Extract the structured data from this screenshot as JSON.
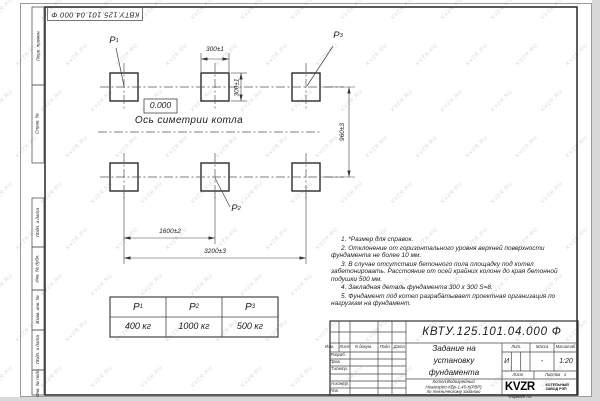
{
  "watermark": {
    "text": "KVZR.RU"
  },
  "frame": {
    "designation_rotated": "КВТУ.125.101.04.000 Ф",
    "format_label": "Формат А3",
    "margin_columns": [
      "Перв. примен.",
      "Справ. №",
      "Подп. и дата",
      "Инв. № дубл.",
      "Взам. инв. №",
      "Подп. и дата",
      "Инв. № подл."
    ]
  },
  "drawing": {
    "elevation_mark": "0.000",
    "axis_label": "Ось симетрии котла",
    "position_labels": [
      {
        "base": "P",
        "sub": "1"
      },
      {
        "base": "P",
        "sub": "2"
      },
      {
        "base": "P",
        "sub": "3"
      }
    ],
    "dimensions": {
      "pad_width": "300±1",
      "pad_height": "300±1",
      "row_spacing": "960±3",
      "column_spacing": "1600±2",
      "total_length": "3200±3"
    }
  },
  "load_table": {
    "headers": [
      {
        "base": "P",
        "sub": "1"
      },
      {
        "base": "P",
        "sub": "2"
      },
      {
        "base": "P",
        "sub": "3"
      }
    ],
    "values": [
      "400 кг",
      "1000 кг",
      "500 кг"
    ]
  },
  "notes": [
    "1. *Размер для справок.",
    "2. Отклонение от горизонтального уровня верхней поверхности фундамента не более 10 мм.",
    "3. В случае отсутствия бетонного пола площадку под котел забетонировать. Расстояние от осей крайних колонн до края бетонной подушки 500 мм.",
    "4. Закладная деталь фундамента 300 x 300 S=8.",
    "5. Фундамент под котел разрабатывает проектная организация по нагрузкам на фундамент."
  ],
  "title_block": {
    "designation": "КВТУ.125.101.04.000 Ф",
    "title_lines": [
      "Задание на",
      "установку",
      "фундамента"
    ],
    "product_lines": [
      "Котел Водогрейный",
      "Heatexpert-КВр-1,45-К(РВР)",
      "по техническому заданию"
    ],
    "change_header": [
      "Изм.",
      "Лист",
      "N докум.",
      "Подп.",
      "Дата"
    ],
    "role_labels": [
      "Разраб.",
      "Пров.",
      "Т.контр.",
      "Н.контр.",
      "Утв."
    ],
    "lit": {
      "header": "Лит.",
      "value": "И"
    },
    "mass": {
      "header": "Масса",
      "value": "-"
    },
    "scale": {
      "header": "Масштаб",
      "value": "1:20"
    },
    "sheet": {
      "header": "Лист"
    },
    "sheets": {
      "header": "Листов",
      "value": "1"
    },
    "company": {
      "logo": "KVZR",
      "name_lines": [
        "КОТЕЛЬНЫЙ",
        "ЗАВОД РЭП"
      ]
    }
  }
}
